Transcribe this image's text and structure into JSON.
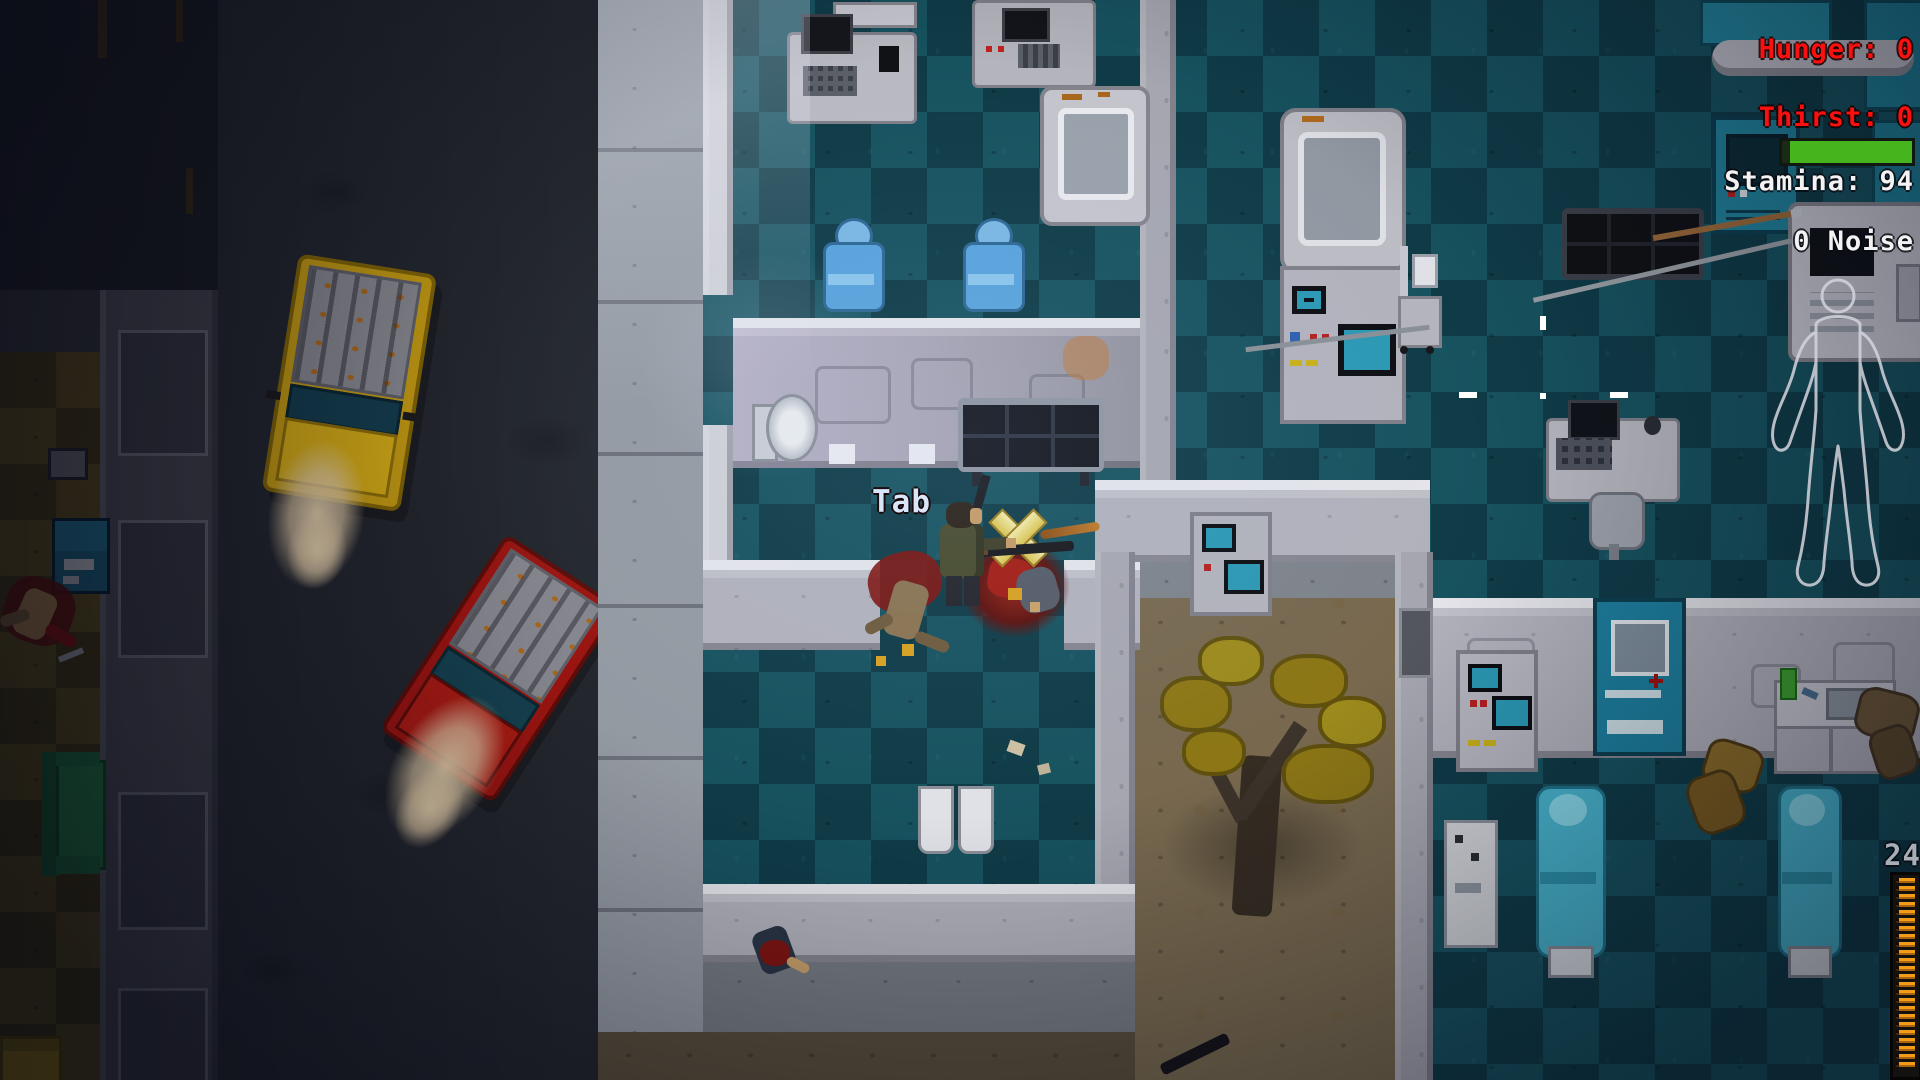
{
  "hud": {
    "hunger": {
      "label": "Hunger: 0",
      "color": "#fb1010"
    },
    "thirst": {
      "label": "Thirst: 0",
      "color": "#fb1010"
    },
    "stamina": {
      "label": "Stamina: 94",
      "value": 94,
      "max": 100,
      "bar_color": "#45b41d",
      "bar_bg": "#1b2a17",
      "text_color": "#f2f2f2"
    },
    "noise": {
      "label": "0 Noise",
      "text_color": "#f2f2f2"
    },
    "ammo": {
      "count": "24",
      "rounds": 24,
      "stripe_color": "#f59d1a",
      "count_color": "#a7aeb6"
    },
    "interact_prompt": {
      "label": "Tab",
      "color": "#d9e6fa"
    },
    "crosshair_color": "#ffffff",
    "body_outline_color": "#d4d4dc"
  },
  "palette": {
    "street": "#23262d",
    "sidewalk": "#949aa2",
    "hospital_floor_light": "#17525f",
    "hospital_floor_dark": "#0f3b47",
    "apartment_floor_light": "#6b5a22",
    "apartment_floor_dark": "#4f431a",
    "wall": "#b1b1bb",
    "wall_trim": "#e4e4ea",
    "truck_yellow": "#bf9712",
    "truck_red": "#9a1410",
    "bed_cyan": "#49b6cf",
    "door_teal": "#1d7f9e",
    "couch_green": "#2f9150",
    "tree_foliage": "#8c7615",
    "blood": "#8e1a12"
  },
  "scene": {
    "entities": [
      "player-survivor",
      "zombie-corpses",
      "yellow-pickup-truck",
      "red-pickup-truck",
      "dead-tree",
      "hospital-beds",
      "medical-machines",
      "office-desks",
      "waiting-chairs",
      "toilet",
      "navy-sofa",
      "green-couch",
      "teal-medical-door",
      "chalk-body-outline",
      "spears-on-floor",
      "hit-marker"
    ]
  }
}
